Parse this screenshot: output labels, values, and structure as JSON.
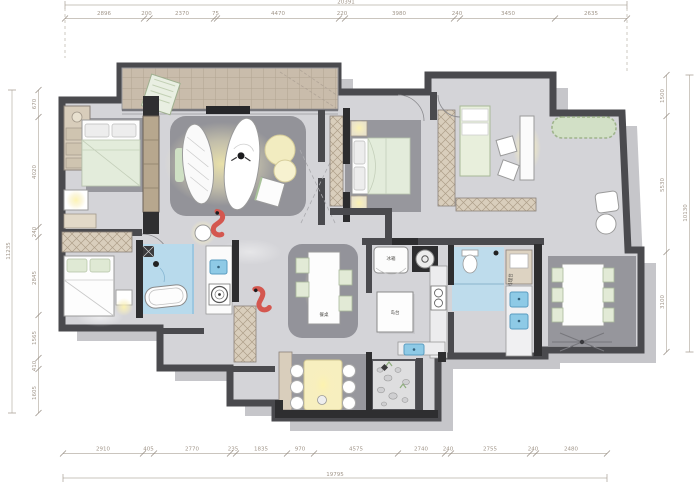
{
  "title": "residential-floor-plan",
  "dims": {
    "top": {
      "total": "20391",
      "segments": [
        "2896",
        "200",
        "2370",
        "75",
        "4470",
        "220",
        "3980",
        "240",
        "3450",
        "2635"
      ]
    },
    "bottom": {
      "total": "19795",
      "segments": [
        "2910",
        "405",
        "2770",
        "235",
        "1835",
        "970",
        "4575",
        "2740",
        "240",
        "2755",
        "240",
        "2480"
      ]
    },
    "left": {
      "total": "11235",
      "segments": [
        "670",
        "4020",
        "240",
        "2845",
        "1565",
        "410",
        "1605"
      ]
    },
    "right": {
      "total": "10130",
      "segments": [
        "1500",
        "5530",
        "3100"
      ]
    }
  },
  "labels": {
    "fridge": "冰箱",
    "island": "岛台",
    "dining_table": "餐桌",
    "prep_counter": "料理台"
  },
  "colors": {
    "wall": "#4a4a4e",
    "wall_dark": "#2e2e30",
    "floor": "#d4d4d8",
    "shadow": "#c6c6ca",
    "rug": "#97979d",
    "tile_beige": "#c9bcab",
    "wood_beige": "#d9cebc",
    "water_blue": "#b8daec",
    "sink_blue": "#8ecae6",
    "plant_green": "#cfe0c4",
    "glow_yellow": "#f6edb4",
    "koi_red": "#d4574f",
    "dim_text": "#a1968a"
  }
}
